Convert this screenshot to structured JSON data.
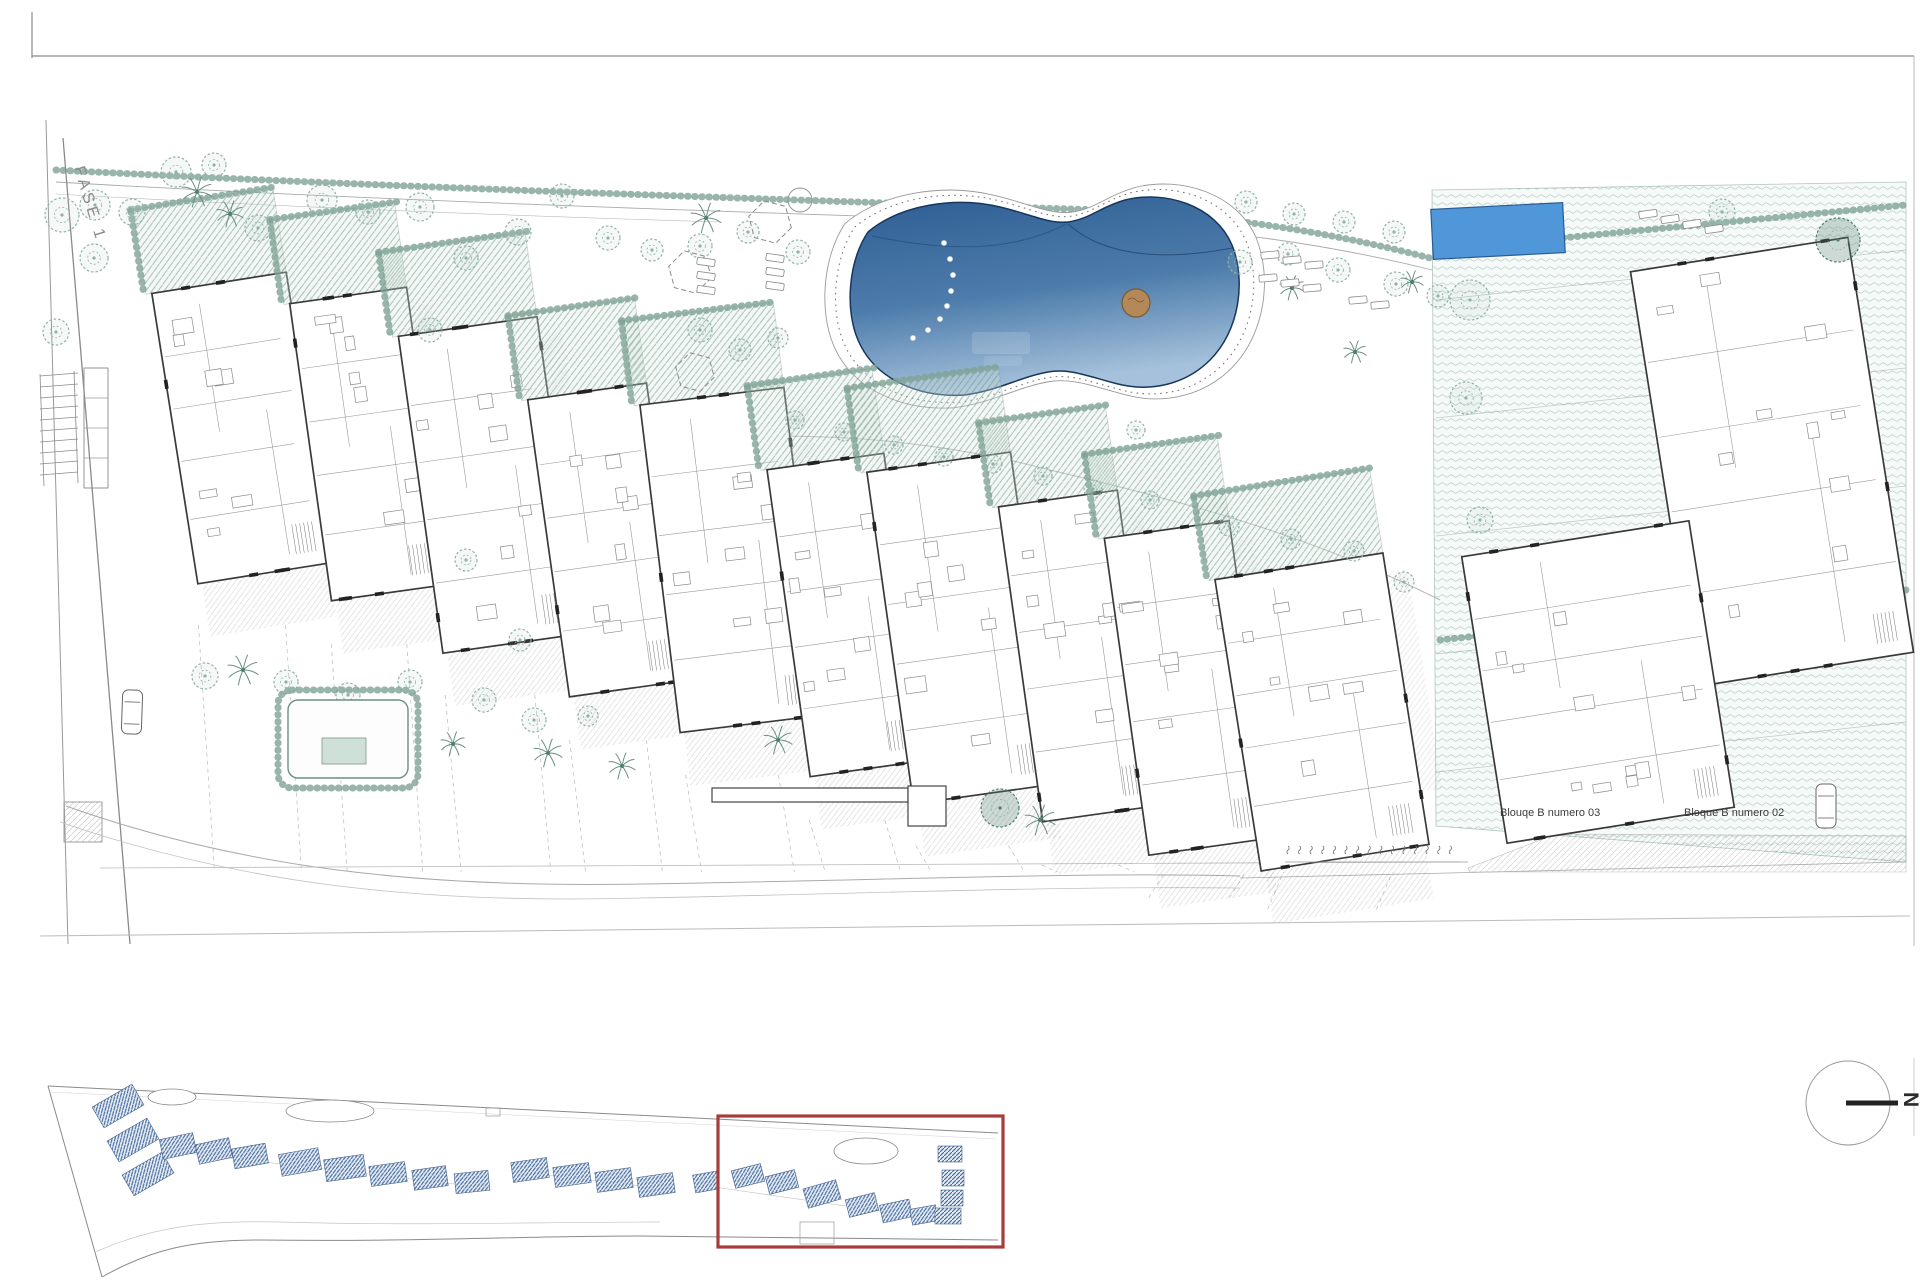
{
  "labels": {
    "fase": "FASE 1",
    "bloque_03": "Blouqe B numero 03",
    "bloque_02": "Bloque B numero 02",
    "north": "N"
  },
  "colors": {
    "paper": "#ffffff",
    "frame": "#8a8a8a",
    "wall": "#3a3a3a",
    "thin_line": "#9a9a9a",
    "hedge_green": "#7fa396",
    "tree_green": "#8fb3a7",
    "tree_dark": "#4f7f6f",
    "pool_top": "#35659b",
    "pool_bottom": "#9dbdd9",
    "pool_edge": "#16365c",
    "small_pool_blue": "#4f97d9",
    "small_pool_edge": "#2a5c93",
    "keyplan_blue": "#4a6fa0",
    "highlight_red": "#a83c3c",
    "label_text": "#3c3c3c"
  },
  "main_plan": {
    "buildings": [
      [
        242,
        428,
        136,
        294,
        -9
      ],
      [
        369,
        444,
        118,
        300,
        -8
      ],
      [
        490,
        485,
        140,
        320,
        -8
      ],
      [
        608,
        540,
        120,
        300,
        -8
      ],
      [
        732,
        560,
        145,
        330,
        -7
      ],
      [
        847,
        615,
        118,
        310,
        -8
      ],
      [
        962,
        628,
        145,
        335,
        -8
      ],
      [
        1080,
        656,
        120,
        318,
        -8
      ],
      [
        1189,
        688,
        126,
        320,
        -8
      ],
      [
        1322,
        712,
        170,
        295,
        -9
      ]
    ],
    "bloque_blocks": [
      [
        1772,
        462,
        220,
        420,
        -9
      ],
      [
        1598,
        682,
        230,
        290,
        -9
      ]
    ],
    "small_pool": [
      1432,
      206,
      132,
      50,
      -3
    ],
    "pool_island": [
      1136,
      303,
      14
    ],
    "trees": [
      [
        62,
        215,
        17,
        0
      ],
      [
        94,
        258,
        14,
        0
      ],
      [
        56,
        332,
        13,
        0
      ],
      [
        95,
        205,
        15,
        0
      ],
      [
        132,
        212,
        13,
        0
      ],
      [
        176,
        172,
        15,
        0
      ],
      [
        214,
        165,
        12,
        0
      ],
      [
        258,
        228,
        13,
        0
      ],
      [
        322,
        200,
        15,
        0
      ],
      [
        368,
        212,
        12,
        0
      ],
      [
        420,
        207,
        14,
        0
      ],
      [
        466,
        258,
        12,
        0
      ],
      [
        518,
        232,
        13,
        0
      ],
      [
        562,
        196,
        12,
        0
      ],
      [
        608,
        238,
        12,
        0
      ],
      [
        652,
        250,
        11,
        0
      ],
      [
        700,
        246,
        12,
        0
      ],
      [
        748,
        232,
        11,
        0
      ],
      [
        798,
        252,
        12,
        0
      ],
      [
        1246,
        202,
        11,
        0
      ],
      [
        1294,
        214,
        11,
        0
      ],
      [
        1344,
        222,
        11,
        0
      ],
      [
        1394,
        232,
        11,
        0
      ],
      [
        1240,
        262,
        12,
        0
      ],
      [
        1288,
        254,
        11,
        0
      ],
      [
        1338,
        270,
        12,
        0
      ],
      [
        1396,
        284,
        12,
        0
      ],
      [
        1438,
        296,
        11,
        0
      ],
      [
        795,
        420,
        9,
        0
      ],
      [
        844,
        432,
        9,
        0
      ],
      [
        894,
        445,
        9,
        0
      ],
      [
        944,
        457,
        9,
        0
      ],
      [
        993,
        464,
        9,
        0
      ],
      [
        1043,
        476,
        9,
        0
      ],
      [
        1093,
        489,
        9,
        0
      ],
      [
        1150,
        500,
        9,
        0
      ],
      [
        1229,
        526,
        10,
        0
      ],
      [
        1291,
        539,
        10,
        0
      ],
      [
        1354,
        551,
        10,
        0
      ],
      [
        1404,
        582,
        10,
        0
      ],
      [
        205,
        676,
        13,
        0
      ],
      [
        286,
        682,
        12,
        0
      ],
      [
        348,
        695,
        12,
        0
      ],
      [
        410,
        682,
        12,
        0
      ],
      [
        484,
        700,
        12,
        0
      ],
      [
        534,
        720,
        12,
        0
      ],
      [
        588,
        716,
        10,
        0
      ],
      [
        700,
        330,
        12,
        0
      ],
      [
        740,
        350,
        11,
        0
      ],
      [
        778,
        338,
        10,
        0
      ],
      [
        1470,
        300,
        20,
        0
      ],
      [
        1466,
        398,
        16,
        0
      ],
      [
        1480,
        520,
        13,
        0
      ],
      [
        1838,
        240,
        22,
        1
      ],
      [
        1722,
        212,
        13,
        0
      ],
      [
        1000,
        808,
        19,
        1
      ],
      [
        466,
        560,
        11,
        0
      ],
      [
        430,
        330,
        12,
        0
      ],
      [
        1136,
        430,
        9,
        0
      ],
      [
        520,
        640,
        11,
        0
      ]
    ],
    "palms": [
      [
        197,
        192,
        16
      ],
      [
        230,
        214,
        14
      ],
      [
        706,
        218,
        16
      ],
      [
        243,
        670,
        16
      ],
      [
        453,
        744,
        13
      ],
      [
        548,
        753,
        15
      ],
      [
        622,
        766,
        14
      ],
      [
        778,
        740,
        15
      ],
      [
        1040,
        820,
        16
      ],
      [
        1292,
        288,
        13
      ],
      [
        1355,
        352,
        12
      ],
      [
        1412,
        282,
        12
      ]
    ],
    "hexagons": [
      [
        770,
        222,
        22
      ],
      [
        690,
        272,
        22
      ],
      [
        695,
        372,
        20
      ]
    ],
    "loungers": [
      [
        706,
        262,
        8
      ],
      [
        706,
        276,
        8
      ],
      [
        706,
        290,
        8
      ],
      [
        775,
        258,
        8
      ],
      [
        775,
        272,
        8
      ],
      [
        775,
        286,
        8
      ],
      [
        1270,
        255,
        -5
      ],
      [
        1292,
        260,
        -5
      ],
      [
        1314,
        265,
        -5
      ],
      [
        1268,
        278,
        -5
      ],
      [
        1290,
        283,
        -5
      ],
      [
        1312,
        288,
        -5
      ],
      [
        1358,
        300,
        -5
      ],
      [
        1380,
        305,
        -5
      ],
      [
        1648,
        214,
        -8
      ],
      [
        1670,
        219,
        -8
      ],
      [
        1692,
        224,
        -8
      ],
      [
        1714,
        229,
        -8
      ]
    ],
    "pool_lights": [
      [
        944,
        243
      ],
      [
        950,
        259
      ],
      [
        953,
        275
      ],
      [
        951,
        291
      ],
      [
        947,
        306
      ],
      [
        940,
        319
      ],
      [
        928,
        330
      ],
      [
        913,
        338
      ]
    ],
    "cars": [
      [
        132,
        712,
        2
      ],
      [
        1826,
        806,
        0
      ]
    ],
    "parking_tick_count": 15
  },
  "key_plan": {
    "left_blocks": [
      [
        118,
        1106,
        46,
        24,
        -30
      ],
      [
        133,
        1140,
        46,
        24,
        -30
      ],
      [
        148,
        1174,
        46,
        24,
        -30
      ]
    ],
    "units": [
      [
        178,
        1146,
        34,
        20,
        -12
      ],
      [
        214,
        1151,
        34,
        20,
        -12
      ],
      [
        250,
        1156,
        34,
        20,
        -10
      ],
      [
        300,
        1162,
        40,
        22,
        -10
      ],
      [
        345,
        1168,
        40,
        22,
        -8
      ],
      [
        388,
        1174,
        36,
        20,
        -8
      ],
      [
        430,
        1178,
        34,
        20,
        -8
      ],
      [
        472,
        1182,
        34,
        20,
        -6
      ],
      [
        530,
        1170,
        36,
        20,
        -8
      ],
      [
        572,
        1175,
        36,
        20,
        -8
      ],
      [
        614,
        1180,
        36,
        20,
        -8
      ],
      [
        656,
        1185,
        36,
        20,
        -8
      ],
      [
        706,
        1182,
        24,
        18,
        -10
      ],
      [
        748,
        1176,
        30,
        18,
        -14
      ],
      [
        782,
        1182,
        30,
        18,
        -14
      ],
      [
        822,
        1194,
        34,
        20,
        -16
      ],
      [
        862,
        1205,
        30,
        18,
        -14
      ],
      [
        896,
        1211,
        30,
        18,
        -12
      ],
      [
        924,
        1215,
        26,
        16,
        -10
      ],
      [
        950,
        1154,
        24,
        16,
        0
      ],
      [
        953,
        1178,
        22,
        16,
        0
      ],
      [
        952,
        1198,
        22,
        16,
        0
      ],
      [
        948,
        1216,
        26,
        16,
        0
      ]
    ],
    "ponds": [
      [
        172,
        1097,
        24,
        8
      ],
      [
        330,
        1111,
        44,
        11
      ],
      [
        866,
        1151,
        32,
        13
      ]
    ],
    "red_box": [
      718,
      1116,
      285,
      131
    ]
  }
}
